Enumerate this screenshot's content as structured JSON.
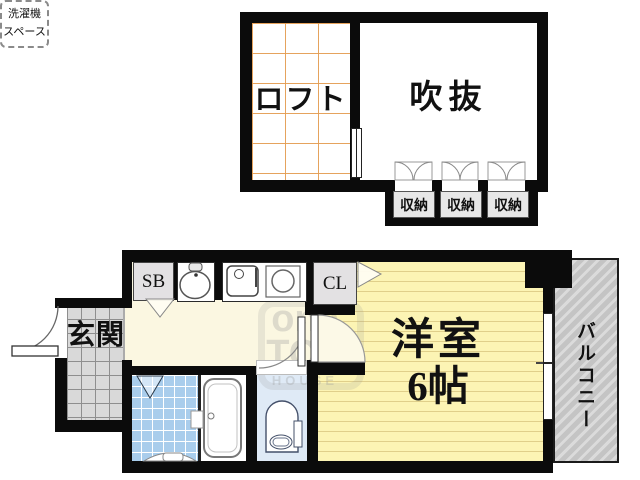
{
  "title": "1K loft apartment floor plan",
  "upper": {
    "loft_label": "ロフト",
    "void_label": "吹抜",
    "storage_labels": [
      "収納",
      "収納",
      "収納"
    ]
  },
  "lower": {
    "entrance_label": "玄関",
    "shoebox_label": "SB",
    "closet_label": "CL",
    "laundry_label_line1": "洗濯機",
    "laundry_label_line2": "スペース",
    "room_label_line1": "洋室",
    "room_label_line2": "6帖",
    "balcony_label": "バルコニー"
  },
  "watermark": {
    "line1": "one",
    "line2": "TOP",
    "line3": "HOUSE"
  },
  "colors": {
    "wall": "#0b0b0b",
    "loft_grid": "#E49E54",
    "hallway_floor": "#FBF7E1",
    "entrance_tile": "#D9D9D9",
    "bathroom_tile": "#A9CDEC",
    "toilet_floor": "#DFEAF6",
    "room_floor": "#FCF4B4",
    "room_floor_line": "#E0CF8A",
    "balcony": "#C4C4C4",
    "cabinet_gray": "#E3E1E3"
  }
}
